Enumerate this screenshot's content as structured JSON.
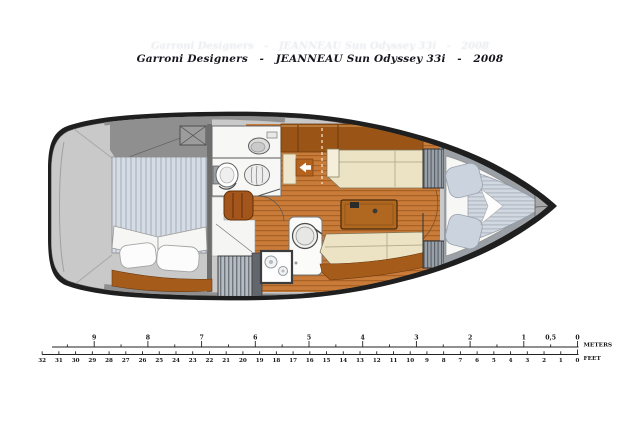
{
  "title": {
    "text": "Garroni Designers   -   JEANNEAU Sun Odyssey 33i   -   2008"
  },
  "colors": {
    "hull_outline": "#1f1f1f",
    "deck_light": "#c9c9c9",
    "deck_mid": "#8f8f8f",
    "wood_floor": "#c97c3a",
    "wood_dark": "#9a5516",
    "cushion_cream": "#ece3c4",
    "mattress_stripe": "#d3d9e1",
    "pillow_white": "#fcfcfc",
    "door_arrow_tile": "#b4631f",
    "head_floor": "#f7f7f5"
  },
  "icons": {
    "hatch": "deck-hatch-x-icon",
    "arrow": "cabin-door-left-arrow-icon",
    "sink": "round-sink-icon",
    "toilet": "toilet-icon",
    "stove": "two-burner-stove-icon"
  },
  "scale": {
    "meters": {
      "unit_label": "METERS",
      "ticks": [
        {
          "label": "9",
          "value": 9
        },
        {
          "label": "8",
          "value": 8
        },
        {
          "label": "7",
          "value": 7
        },
        {
          "label": "6",
          "value": 6
        },
        {
          "label": "5",
          "value": 5
        },
        {
          "label": "4",
          "value": 4
        },
        {
          "label": "3",
          "value": 3
        },
        {
          "label": "2",
          "value": 2
        },
        {
          "label": "1",
          "value": 1
        },
        {
          "label": "0,5",
          "value": 0.5
        },
        {
          "label": "0",
          "value": 0
        }
      ]
    },
    "feet": {
      "unit_label": "FEET",
      "labels": [
        "32",
        "31",
        "30",
        "29",
        "28",
        "27",
        "26",
        "25",
        "24",
        "23",
        "22",
        "21",
        "20",
        "19",
        "18",
        "17",
        "16",
        "15",
        "14",
        "13",
        "12",
        "11",
        "10",
        "9",
        "8",
        "7",
        "6",
        "5",
        "4",
        "3",
        "2",
        "1",
        "0"
      ]
    }
  }
}
